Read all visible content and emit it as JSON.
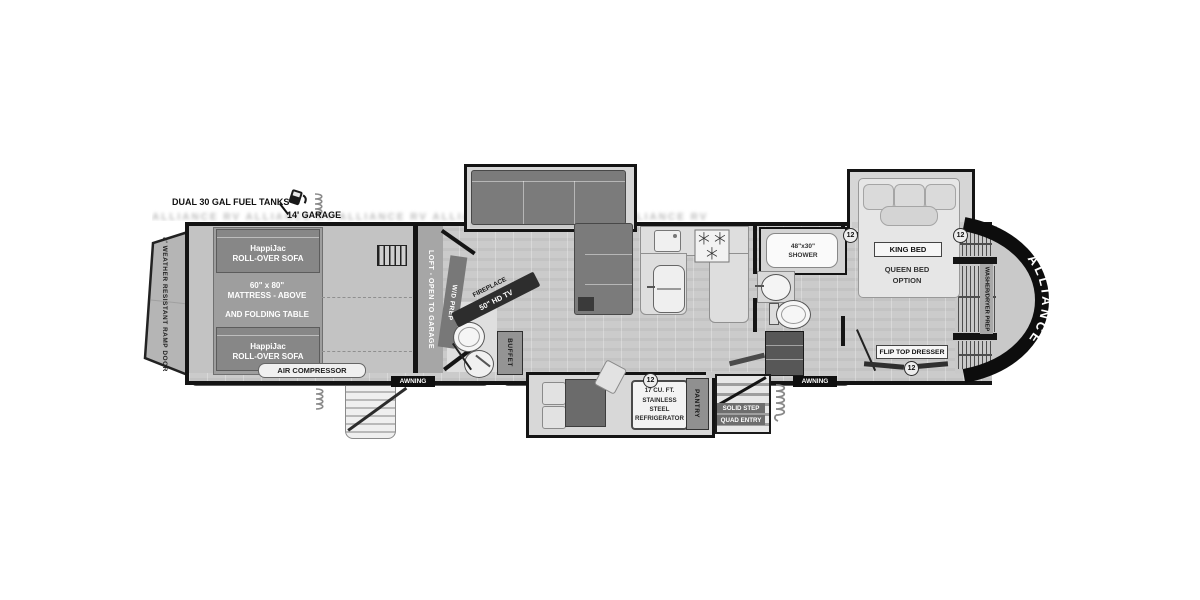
{
  "floorplan": {
    "brand": "ALLIANCE",
    "badge": "12",
    "watermark": "ALLIANCE RV ALLIANCE RV ALLIANCE RV ALLIANCE RV ALLIANCE RV ALLIANCE RV",
    "header": {
      "fuel": "DUAL 30 GAL FUEL TANKS",
      "garage_length": "14' GARAGE"
    },
    "garage": {
      "ramp_door": "8' WEATHER RESISTANT RAMP DOOR",
      "sofa_brand": "HappiJac",
      "sofa_type": "ROLL-OVER SOFA",
      "mattress_size": "60\" x 80\"",
      "mattress_note": "MATTRESS - ABOVE",
      "folding_table": "AND FOLDING TABLE",
      "air_compressor": "AIR COMPRESSOR",
      "loft": "LOFT - OPEN TO GARAGE",
      "wd_prep": "W/D PREP"
    },
    "living": {
      "fireplace": "FIREPLACE",
      "tv": "50\" HD TV",
      "buffet": "BUFFET",
      "pantry": "PANTRY",
      "fridge_line1": "17 CU. FT.",
      "fridge_line2": "STAINLESS STEEL",
      "fridge_line3": "REFRIGERATOR",
      "entry_line1": "SOLID STEP",
      "entry_line2": "QUAD ENTRY"
    },
    "bath": {
      "shower_size": "48\"x30\"",
      "shower": "SHOWER"
    },
    "bedroom": {
      "king_bed": "KING BED",
      "queen_line1": "QUEEN BED",
      "queen_line2": "OPTION",
      "dresser": "FLIP TOP DRESSER",
      "wardrobe": "WASHER/DRYER PREP"
    },
    "exterior": {
      "awning": "AWNING"
    }
  }
}
